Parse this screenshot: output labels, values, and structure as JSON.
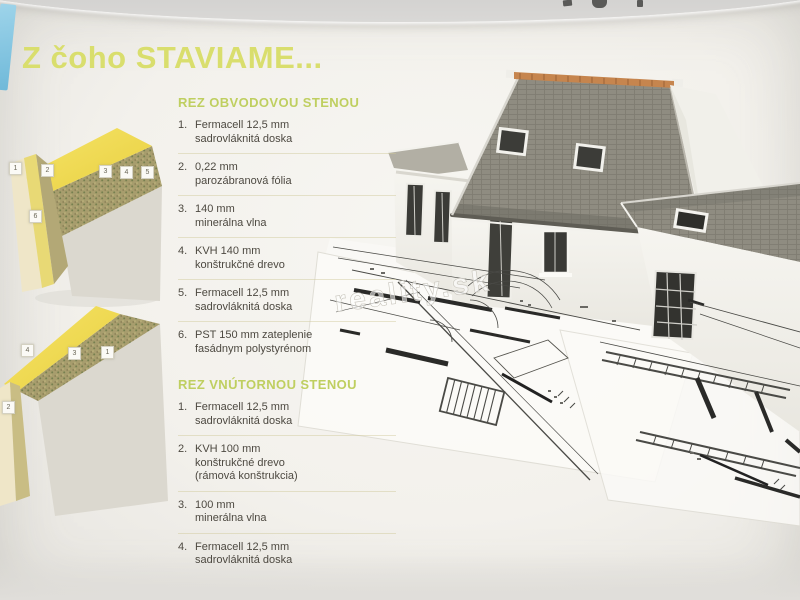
{
  "page": {
    "title": "Z čoho STAVIAME...",
    "watermark": "reality.sk"
  },
  "sections": [
    {
      "heading": "REZ OBVODOVOU STENOU",
      "items": [
        {
          "num": "1.",
          "line1": "Fermacell 12,5 mm",
          "line2": "sadrovláknitá doska"
        },
        {
          "num": "2.",
          "line1": "0,22 mm",
          "line2": "parozábranová fólia"
        },
        {
          "num": "3.",
          "line1": "140 mm",
          "line2": "minerálna vlna"
        },
        {
          "num": "4.",
          "line1": "KVH 140 mm",
          "line2": "konštrukčné drevo"
        },
        {
          "num": "5.",
          "line1": "Fermacell 12,5 mm",
          "line2": "sadrovláknitá doska"
        },
        {
          "num": "6.",
          "line1": "PST 150 mm zateplenie",
          "line2": "fasádnym polystyrénom"
        }
      ],
      "diagram_labels": [
        "1",
        "2",
        "3",
        "4",
        "5",
        "6"
      ]
    },
    {
      "heading": "REZ VNÚTORNOU STENOU",
      "items": [
        {
          "num": "1.",
          "line1": "Fermacell 12,5 mm",
          "line2": "sadrovláknitá doska"
        },
        {
          "num": "2.",
          "line1": "KVH 100 mm",
          "line2": "konštrukčné drevo",
          "line3": "(rámová konštrukcia)"
        },
        {
          "num": "3.",
          "line1": "100 mm",
          "line2": "minerálna vlna"
        },
        {
          "num": "4.",
          "line1": "Fermacell 12,5 mm",
          "line2": "sadrovláknitá doska"
        }
      ],
      "diagram_labels": [
        "4",
        "3",
        "1",
        "2"
      ]
    }
  ],
  "colors": {
    "title_green": "#d9de6d",
    "heading_green": "#bfcf60",
    "body_text": "#4d4941",
    "roof_gray": "#8f8c81",
    "ridge_orange": "#c6854e",
    "insulation_yellow": "#f0dc55",
    "mineral_wool_olive": "#a39a66",
    "paper": "#f4f2ee",
    "corner_blue": "#7ec2de"
  }
}
